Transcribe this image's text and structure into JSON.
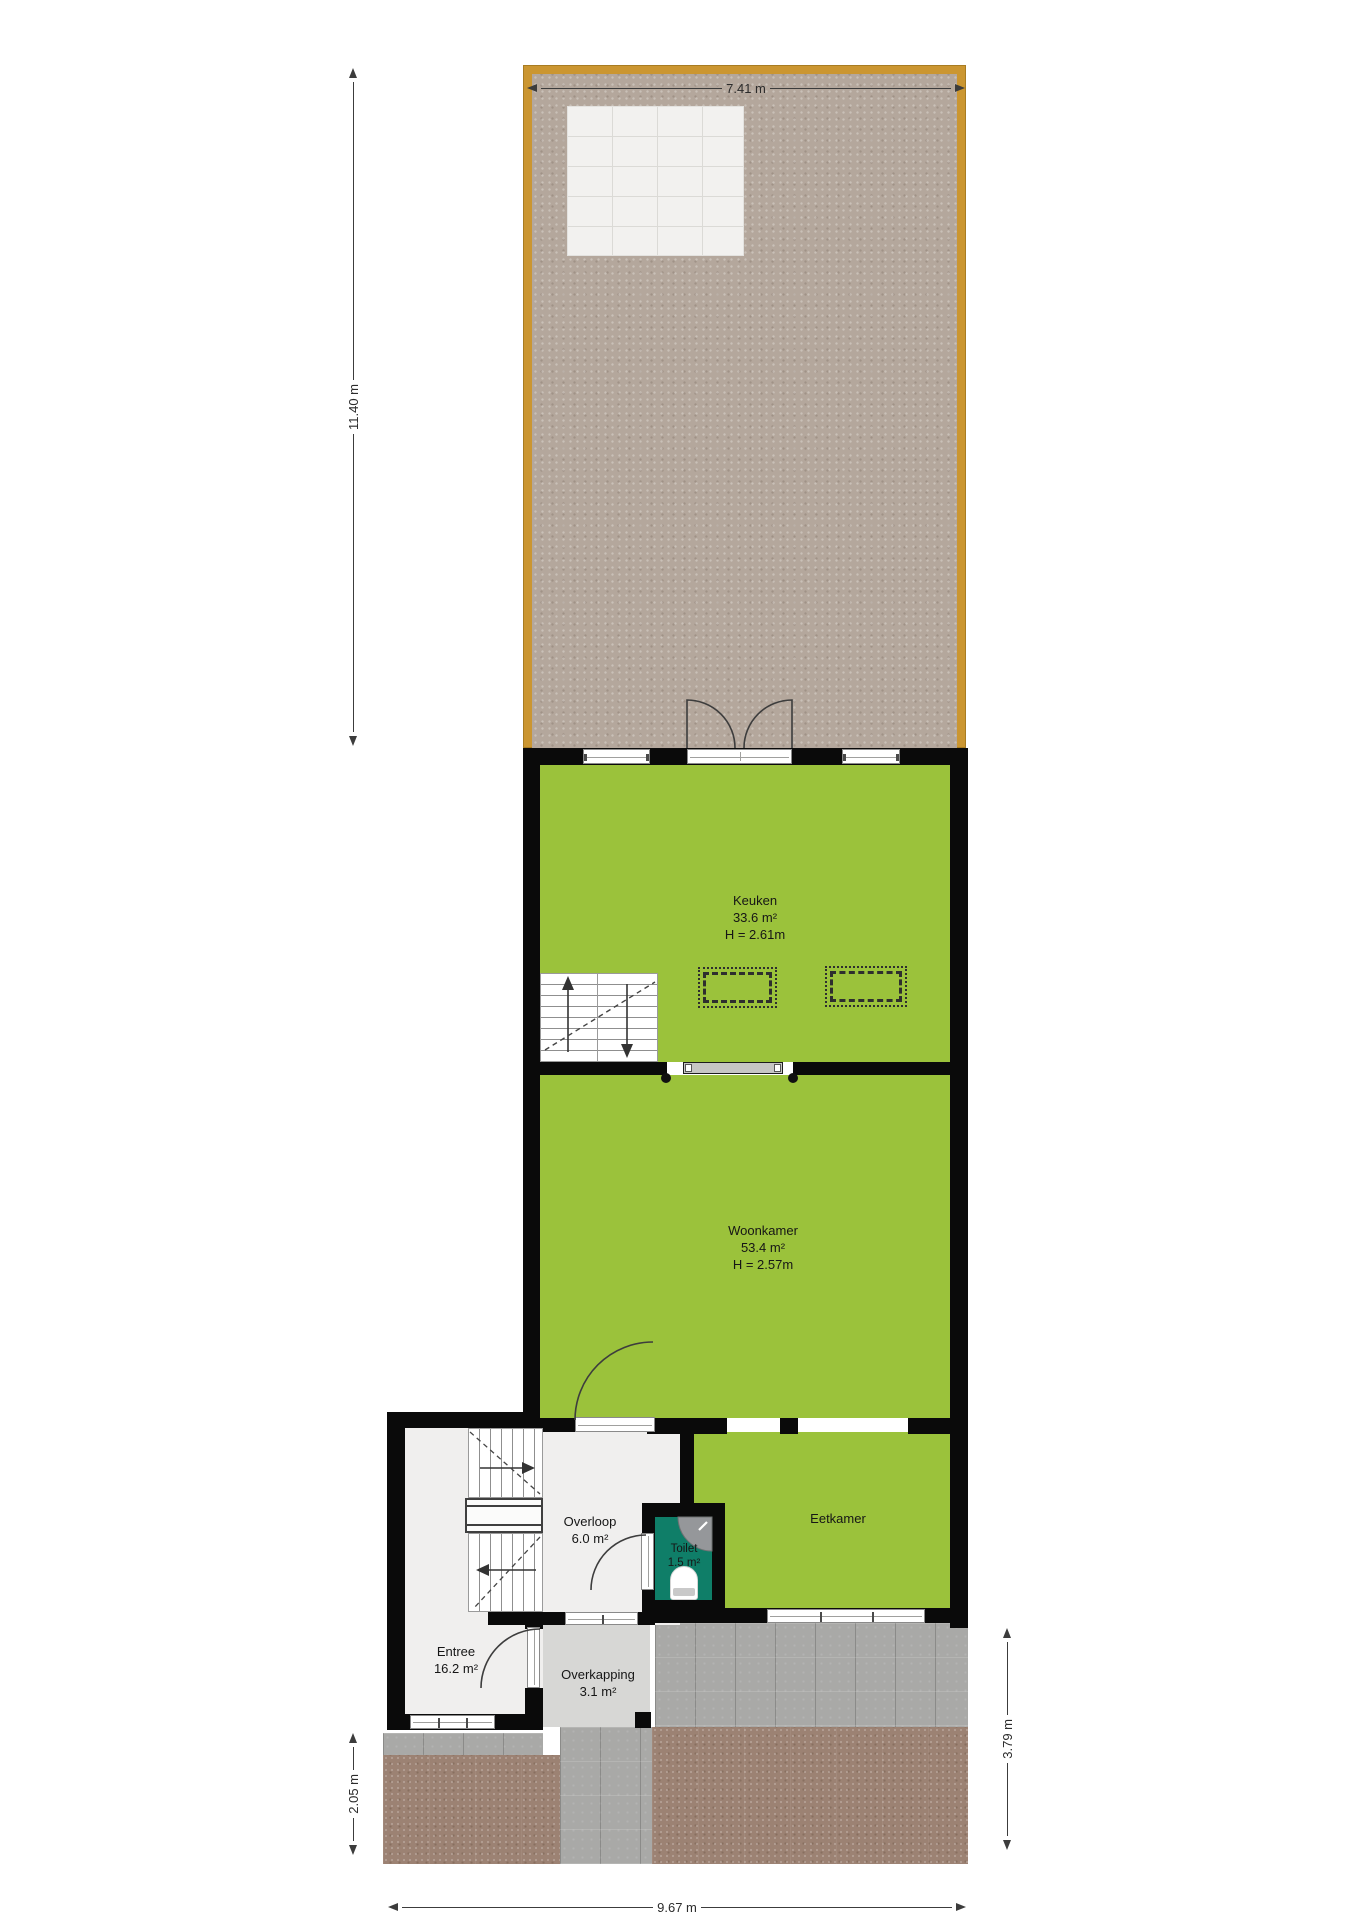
{
  "rooms": {
    "keuken": {
      "name": "Keuken",
      "area": "33.6 m²",
      "height": "H = 2.61m"
    },
    "woonkamer": {
      "name": "Woonkamer",
      "area": "53.4 m²",
      "height": "H = 2.57m"
    },
    "eetkamer": {
      "name": "Eetkamer"
    },
    "overloop": {
      "name": "Overloop",
      "area": "6.0 m²"
    },
    "toilet": {
      "name": "Toilet",
      "area": "1.5 m²"
    },
    "entree": {
      "name": "Entree",
      "area": "16.2 m²"
    },
    "overkapping": {
      "name": "Overkapping",
      "area": "3.1 m²"
    }
  },
  "dimensions": {
    "top": "7.41 m",
    "garden_left": "11.40 m",
    "front_left": "2.05 m",
    "front_right": "3.79 m",
    "bottom": "9.67 m"
  },
  "colors": {
    "room_green": "#9bc23b",
    "toilet_teal": "#0f7e68",
    "wall_black": "#0a0a0a",
    "garden_fence_gold": "#cb9631",
    "garden_ground": "#b4a79c",
    "patio_white": "#f2f1ef",
    "paver_gray": "#a9a9a7",
    "paver_brown": "#9c8273",
    "overkapping_gray": "#d7d7d5",
    "floor_light": "#f0efee"
  }
}
